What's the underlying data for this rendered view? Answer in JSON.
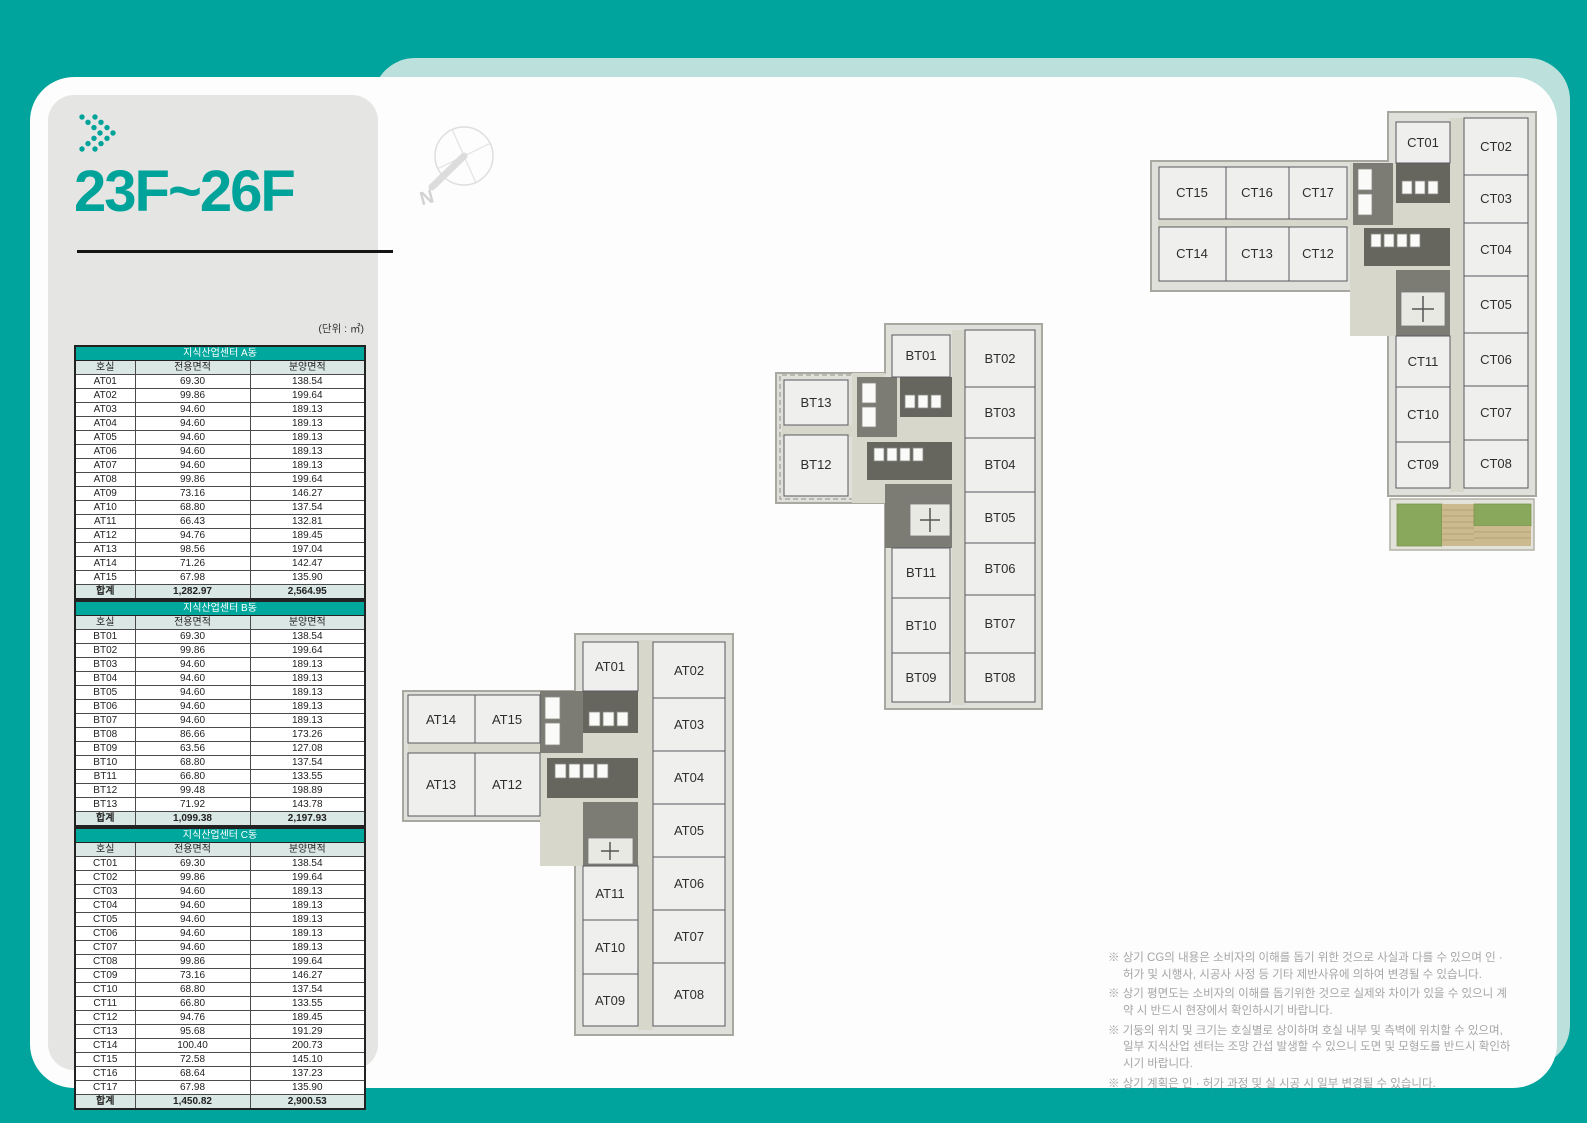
{
  "header": {
    "title": "23F~26F",
    "unit_label": "(단위 : ㎡)"
  },
  "tables": [
    {
      "title": "지식산업센터 A동",
      "columns": [
        "호실",
        "전용면적",
        "분양면적"
      ],
      "rows": [
        [
          "AT01",
          "69.30",
          "138.54"
        ],
        [
          "AT02",
          "99.86",
          "199.64"
        ],
        [
          "AT03",
          "94.60",
          "189.13"
        ],
        [
          "AT04",
          "94.60",
          "189.13"
        ],
        [
          "AT05",
          "94.60",
          "189.13"
        ],
        [
          "AT06",
          "94.60",
          "189.13"
        ],
        [
          "AT07",
          "94.60",
          "189.13"
        ],
        [
          "AT08",
          "99.86",
          "199.64"
        ],
        [
          "AT09",
          "73.16",
          "146.27"
        ],
        [
          "AT10",
          "68.80",
          "137.54"
        ],
        [
          "AT11",
          "66.43",
          "132.81"
        ],
        [
          "AT12",
          "94.76",
          "189.45"
        ],
        [
          "AT13",
          "98.56",
          "197.04"
        ],
        [
          "AT14",
          "71.26",
          "142.47"
        ],
        [
          "AT15",
          "67.98",
          "135.90"
        ]
      ],
      "total": [
        "합계",
        "1,282.97",
        "2,564.95"
      ]
    },
    {
      "title": "지식산업센터 B동",
      "columns": [
        "호실",
        "전용면적",
        "분양면적"
      ],
      "rows": [
        [
          "BT01",
          "69.30",
          "138.54"
        ],
        [
          "BT02",
          "99.86",
          "199.64"
        ],
        [
          "BT03",
          "94.60",
          "189.13"
        ],
        [
          "BT04",
          "94.60",
          "189.13"
        ],
        [
          "BT05",
          "94.60",
          "189.13"
        ],
        [
          "BT06",
          "94.60",
          "189.13"
        ],
        [
          "BT07",
          "94.60",
          "189.13"
        ],
        [
          "BT08",
          "86.66",
          "173.26"
        ],
        [
          "BT09",
          "63.56",
          "127.08"
        ],
        [
          "BT10",
          "68.80",
          "137.54"
        ],
        [
          "BT11",
          "66.80",
          "133.55"
        ],
        [
          "BT12",
          "99.48",
          "198.89"
        ],
        [
          "BT13",
          "71.92",
          "143.78"
        ]
      ],
      "total": [
        "합계",
        "1,099.38",
        "2,197.93"
      ]
    },
    {
      "title": "지식산업센터 C동",
      "columns": [
        "호실",
        "전용면적",
        "분양면적"
      ],
      "rows": [
        [
          "CT01",
          "69.30",
          "138.54"
        ],
        [
          "CT02",
          "99.86",
          "199.64"
        ],
        [
          "CT03",
          "94.60",
          "189.13"
        ],
        [
          "CT04",
          "94.60",
          "189.13"
        ],
        [
          "CT05",
          "94.60",
          "189.13"
        ],
        [
          "CT06",
          "94.60",
          "189.13"
        ],
        [
          "CT07",
          "94.60",
          "189.13"
        ],
        [
          "CT08",
          "99.86",
          "199.64"
        ],
        [
          "CT09",
          "73.16",
          "146.27"
        ],
        [
          "CT10",
          "68.80",
          "137.54"
        ],
        [
          "CT11",
          "66.80",
          "133.55"
        ],
        [
          "CT12",
          "94.76",
          "189.45"
        ],
        [
          "CT13",
          "95.68",
          "191.29"
        ],
        [
          "CT14",
          "100.40",
          "200.73"
        ],
        [
          "CT15",
          "72.58",
          "145.10"
        ],
        [
          "CT16",
          "68.64",
          "137.23"
        ],
        [
          "CT17",
          "67.98",
          "135.90"
        ]
      ],
      "total": [
        "합계",
        "1,450.82",
        "2,900.53"
      ]
    }
  ],
  "plans": {
    "a": {
      "rooms": [
        "AT01",
        "AT02",
        "AT03",
        "AT04",
        "AT05",
        "AT06",
        "AT07",
        "AT08",
        "AT09",
        "AT10",
        "AT11",
        "AT12",
        "AT13",
        "AT14",
        "AT15"
      ]
    },
    "b": {
      "rooms": [
        "BT01",
        "BT02",
        "BT03",
        "BT04",
        "BT05",
        "BT06",
        "BT07",
        "BT08",
        "BT09",
        "BT10",
        "BT11",
        "BT12",
        "BT13"
      ]
    },
    "c": {
      "rooms": [
        "CT01",
        "CT02",
        "CT03",
        "CT04",
        "CT05",
        "CT06",
        "CT07",
        "CT08",
        "CT09",
        "CT10",
        "CT11",
        "CT12",
        "CT13",
        "CT14",
        "CT15",
        "CT16",
        "CT17"
      ]
    }
  },
  "compass": {
    "north_label": "N"
  },
  "footnotes": [
    "※ 상기 CG의 내용은 소비자의 이해를 돕기 위한 것으로 사실과 다를 수 있으며 인 · 허가 및 시행사, 시공사 사정 등 기타 제반사유에 의하여 변경될 수 있습니다.",
    "※ 상기 평면도는 소비자의 이해를 돕기위한 것으로 실제와 차이가 있을 수 있으니 계약 시 반드시 현장에서 확인하시기 바랍니다.",
    "※ 기둥의 위치 및 크기는 호실별로 상이하며 호실 내부 및 측벽에 위치할 수 있으며, 일부 지식산업 센터는 조망 간섭 발생할 수 있으니 도면 및 모형도를 반드시 확인하시기 바랍니다.",
    "※ 상기 계획은 인 · 허가 과정 및 실 시공 시 일부 변경될 수 있습니다."
  ]
}
